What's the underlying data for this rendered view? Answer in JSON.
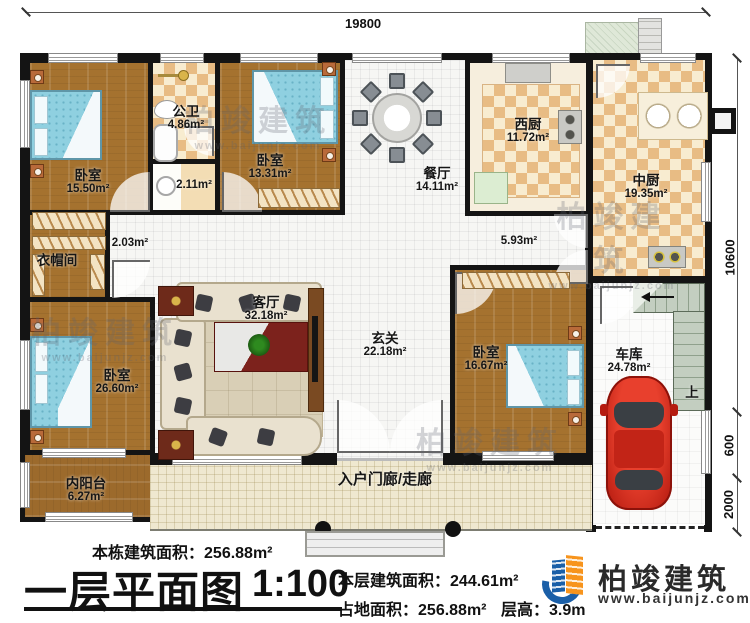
{
  "palette": {
    "wall": "#141414",
    "wood": "#a5722f",
    "tile": "#e8bc84",
    "hall": "#f6f6f4",
    "porch": "#efe8d0",
    "bed": "#8fd0e0",
    "car": "#c0241a",
    "brand_blue": "#1a5fa8",
    "brand_orange": "#f7941d"
  },
  "dims": {
    "top": "19800",
    "right_top": "10600",
    "right_mid": "600",
    "right_bottom": "2000"
  },
  "rooms": {
    "bedroom_tl": {
      "name": "卧室",
      "area": "15.50m²"
    },
    "bathroom": {
      "name": "公卫",
      "area": "4.86m²"
    },
    "washroom": {
      "area": "2.11m²"
    },
    "bedroom_tm": {
      "name": "卧室",
      "area": "13.31m²"
    },
    "hall_small": {
      "area": "2.03m²"
    },
    "cloakroom": {
      "name": "衣帽间"
    },
    "bedroom_left": {
      "name": "卧室",
      "area": "26.60m²"
    },
    "balcony": {
      "name": "内阳台",
      "area": "6.27m²"
    },
    "living": {
      "name": "客厅",
      "area": "32.18m²"
    },
    "foyer": {
      "name": "玄关",
      "area": "22.18m²"
    },
    "dining": {
      "name": "餐厅",
      "area": "14.11m²"
    },
    "west_kitchen": {
      "name": "西厨",
      "area": "11.72m²"
    },
    "main_kitchen": {
      "name": "中厨",
      "area": "19.35m²"
    },
    "hall_mid": {
      "area": "5.93m²"
    },
    "bedroom_right": {
      "name": "卧室",
      "area": "16.67m²"
    },
    "garage": {
      "name": "车库",
      "area": "24.78m²"
    },
    "porch": {
      "name": "入户门廊/走廊"
    }
  },
  "stairs": {
    "up": "上"
  },
  "footer": {
    "building_area_label": "本栋建筑面积：",
    "building_area_value": "256.88m²",
    "title": "一层平面图",
    "scale": "1:100",
    "floor_area_label": "本层建筑面积：",
    "floor_area_value": "244.61m²",
    "land_area_label": "占地面积：",
    "land_area_value": "256.88m²",
    "floor_height_label": "层高：",
    "floor_height_value": "3.9m"
  },
  "brand": {
    "name": "柏竣建筑",
    "website": "www.baijunjz.com"
  },
  "watermark": {
    "text": "柏竣建筑",
    "sub": "www.baijunjz.com"
  }
}
